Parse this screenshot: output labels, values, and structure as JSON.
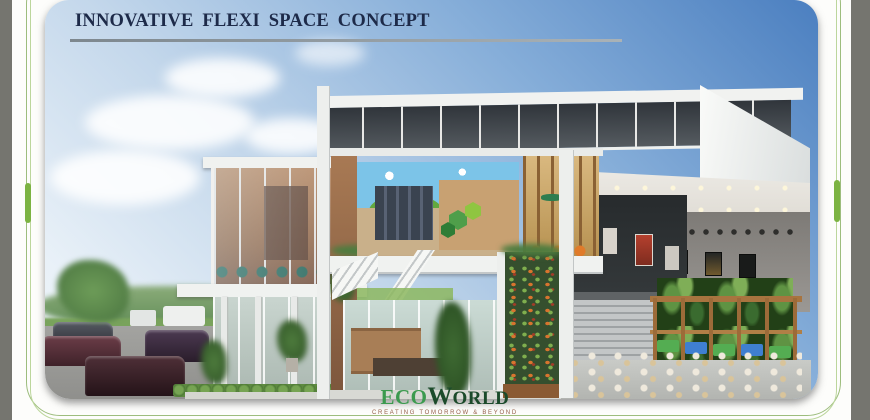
{
  "page": {
    "title": "INNOVATIVE FLEXI SPACE CONCEPT",
    "colors": {
      "title_text": "#1d2a49",
      "title_underline": "#8b9499",
      "frame_green_line": "#9dbd7d",
      "frame_green_accent": "#7cb342",
      "side_gray": "#75756f",
      "sky_deep": "#4b7fc0",
      "sky_light": "#eef4f9"
    }
  },
  "scene": {
    "description": "Cross-section architectural rendering of a flexi commercial space: glass pavilion and parking at left, sectioned interiors with staircase and vertical garden in the centre, double-height gallery and dining terrace at right"
  },
  "logo": {
    "part1": "ECO",
    "part2_initial": "W",
    "part2_rest": "ORLD",
    "tagline": "CREATING TOMORROW & BEYOND",
    "color_primary": "#3c9a4f",
    "color_secondary": "#1b4a2a"
  }
}
